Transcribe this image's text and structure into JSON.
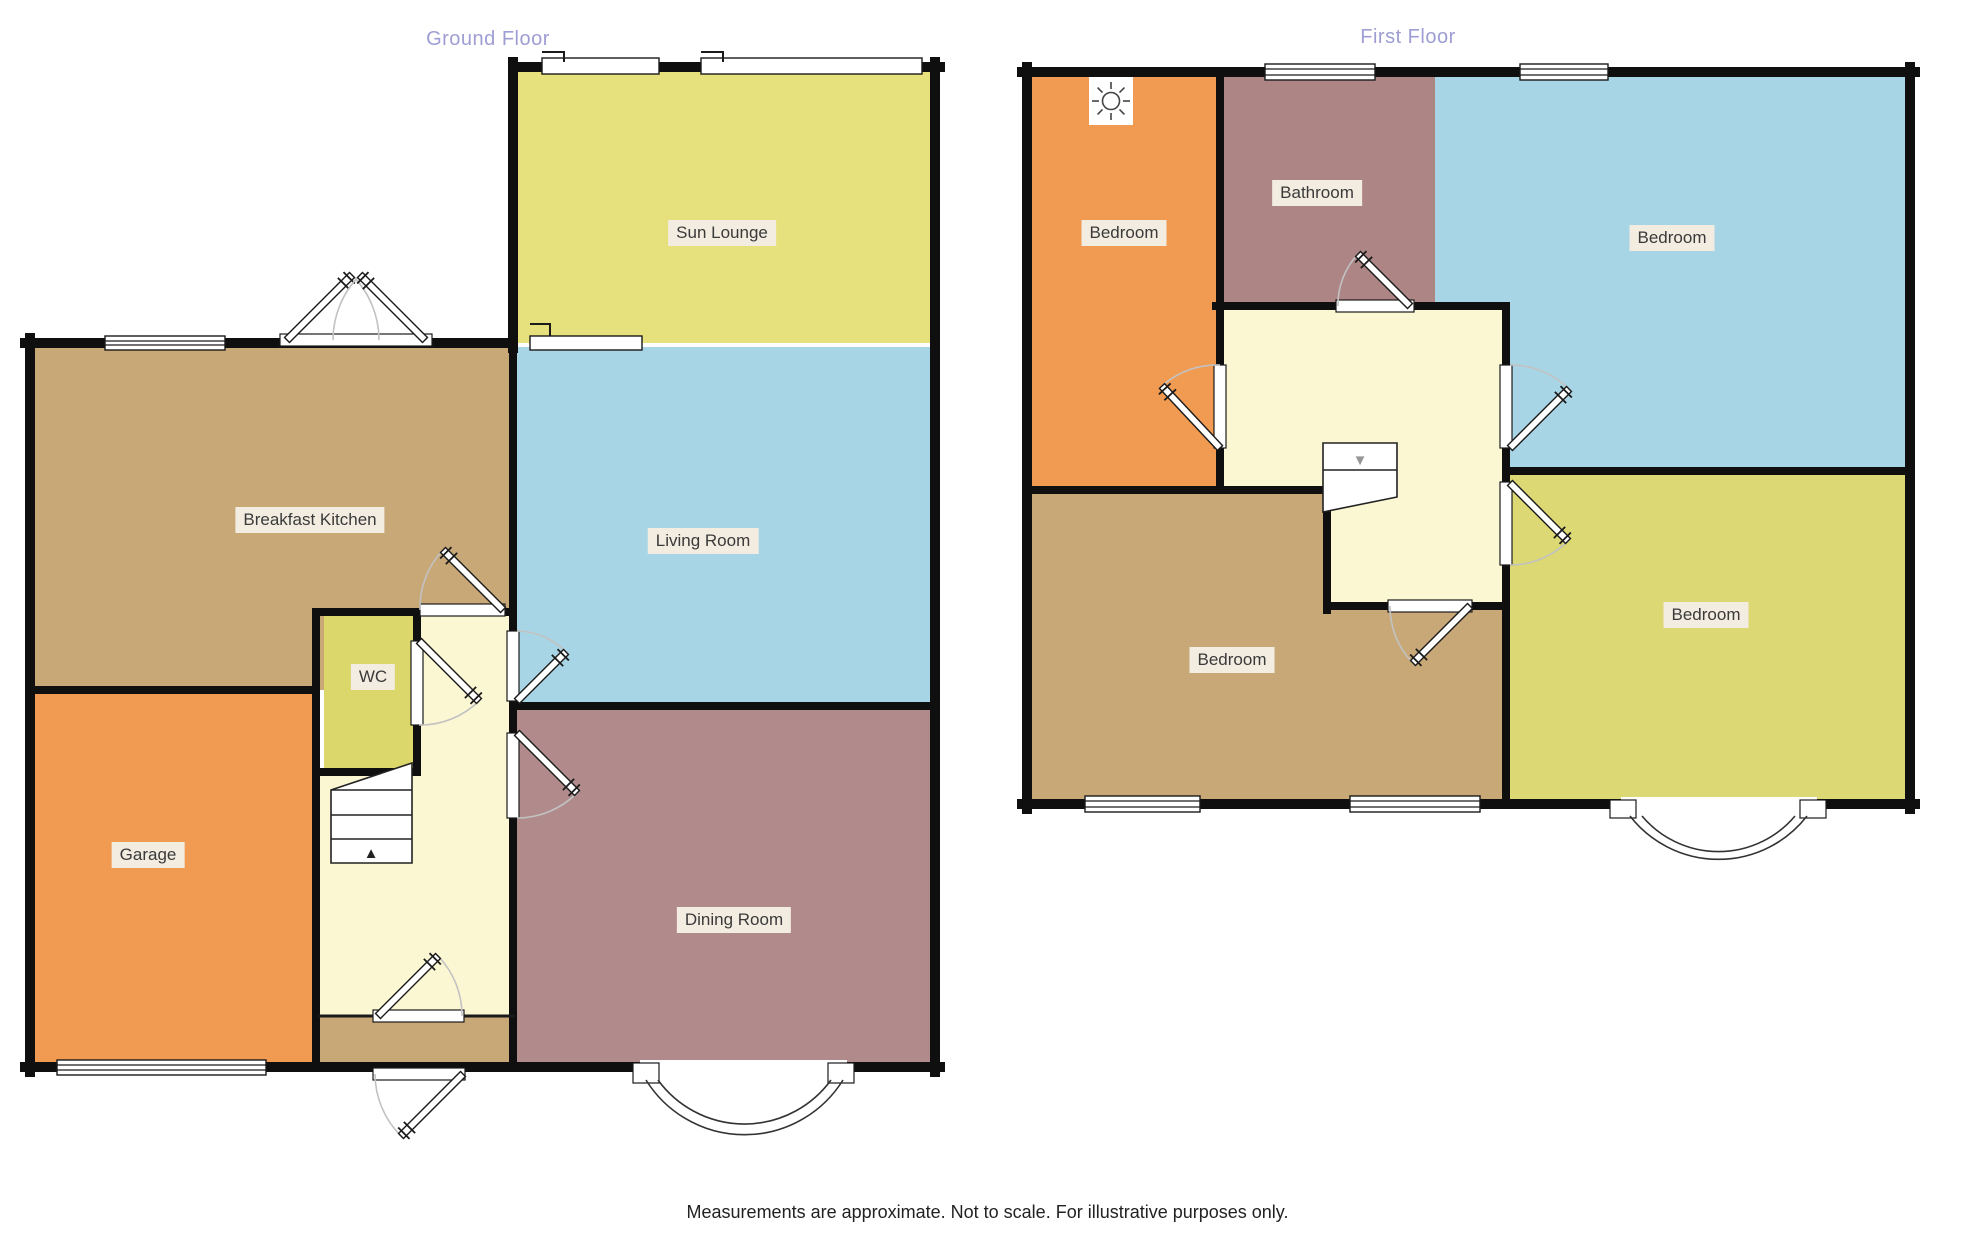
{
  "titles": {
    "ground_floor": "Ground Floor",
    "first_floor": "First Floor"
  },
  "footer": {
    "disclaimer": "Measurements are approximate. Not to scale. For illustrative purposes only."
  },
  "ground_floor": {
    "sun_lounge": {
      "label": "Sun Lounge"
    },
    "breakfast_kitchen": {
      "label": "Breakfast Kitchen"
    },
    "living_room": {
      "label": "Living Room"
    },
    "wc": {
      "label": "WC"
    },
    "garage": {
      "label": "Garage"
    },
    "dining_room": {
      "label": "Dining Room"
    }
  },
  "first_floor": {
    "bedroom_front": {
      "label": "Bedroom"
    },
    "bathroom": {
      "label": "Bathroom"
    },
    "bedroom_large": {
      "label": "Bedroom"
    },
    "bedroom_back": {
      "label": "Bedroom"
    },
    "bedroom_bay": {
      "label": "Bedroom"
    }
  },
  "icons": {
    "stairs_up_glyph": "▲",
    "stairs_down_glyph": "▼",
    "light_icon": "ceiling-light"
  },
  "colors": {
    "wall": "#0f0f0f",
    "title_text": "#9e9ed4",
    "label_bg": "#f3ece1",
    "label_text": "#3a3a3a",
    "sun_lounge": "#e6e17c",
    "wc": "#dcd76a",
    "bedroom_yellow": "#dcd873",
    "kitchen_tan": "#c9a878",
    "living_blue": "#a8d5e5",
    "garage_orange": "#f09b51",
    "dining_mauve": "#b18b8b",
    "bathroom_mauve": "#ad8585",
    "hall_cream": "#fbf7d3"
  }
}
